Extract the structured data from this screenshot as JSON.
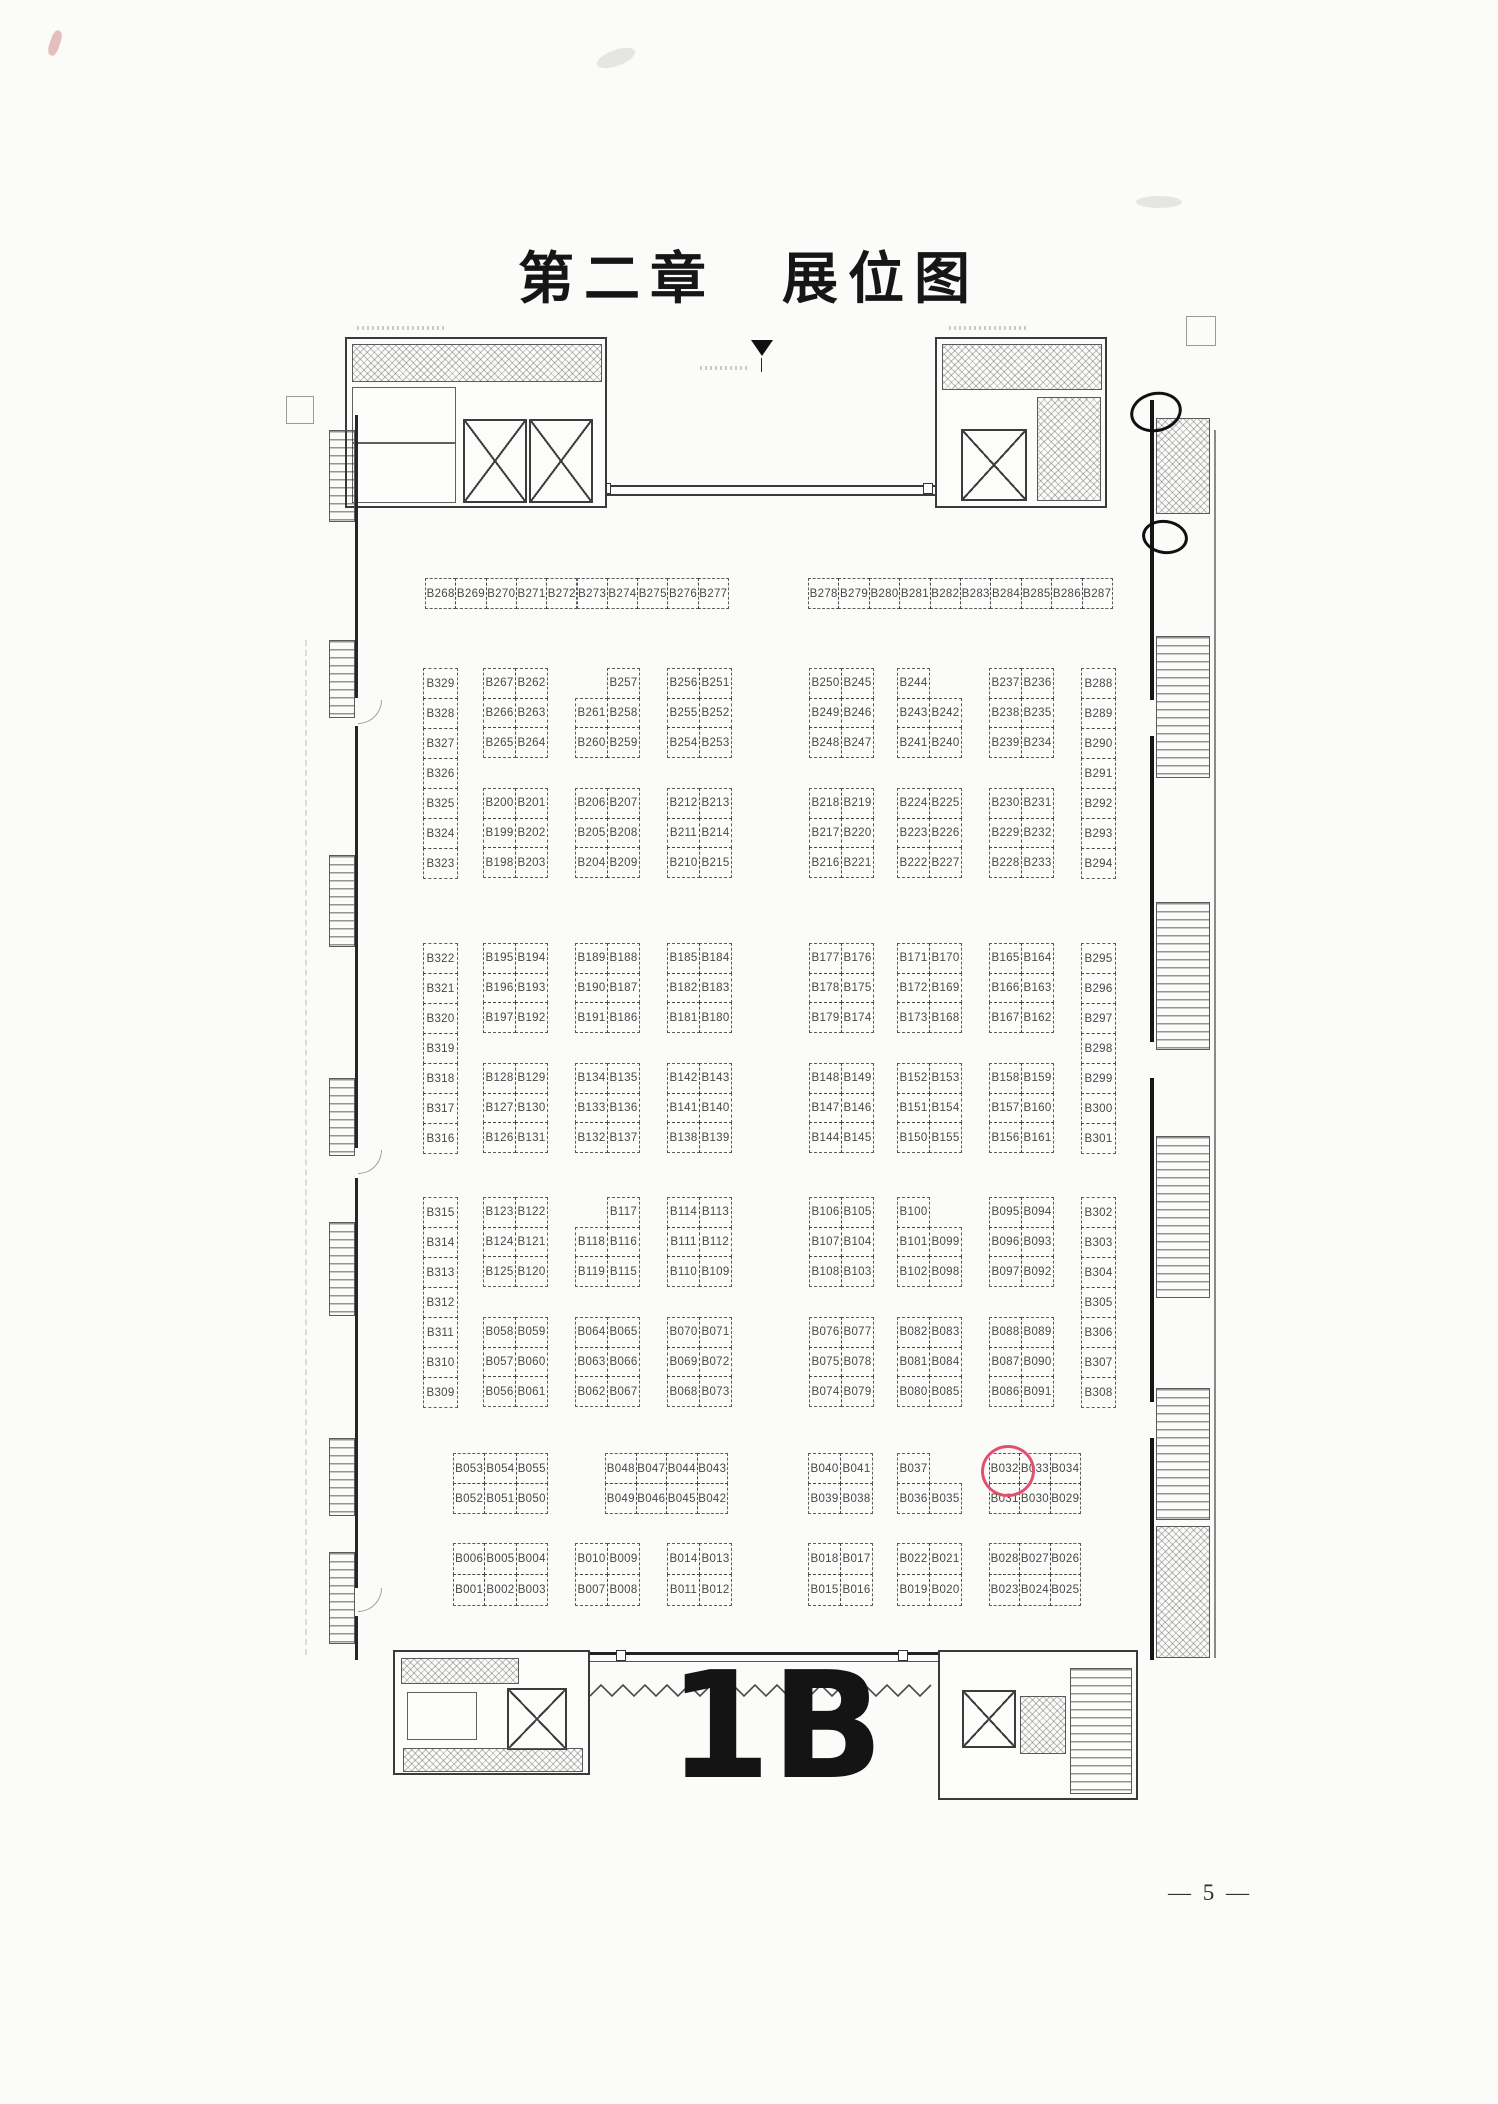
{
  "page": {
    "title": "第二章　展位图",
    "hall_label": "1B",
    "page_number": "— 5 —"
  },
  "plan": {
    "highlight": {
      "booth": "B032",
      "x": 981,
      "y": 1445,
      "w": 48,
      "h": 46,
      "color": "#e2506e"
    },
    "blocks": [
      {
        "id": "strip-top-left",
        "x": 425,
        "y": 578,
        "cw": 30.3,
        "rh": 30,
        "rows": [
          [
            "B268",
            "B269",
            "B270",
            "B271",
            "B272",
            "B273",
            "B274",
            "B275",
            "B276",
            "B277"
          ]
        ]
      },
      {
        "id": "strip-top-right",
        "x": 808,
        "y": 578,
        "cw": 30.4,
        "rh": 30,
        "rows": [
          [
            "B278",
            "B279",
            "B280",
            "B281",
            "B282",
            "B283",
            "B284",
            "B285",
            "B286",
            "B287"
          ]
        ]
      },
      {
        "id": "col-left-band1",
        "x": 423,
        "y": 668,
        "cw": 34,
        "rh": 30,
        "rows": [
          [
            "B329"
          ],
          [
            "B328"
          ],
          [
            "B327"
          ],
          [
            "B326"
          ],
          [
            "B325"
          ],
          [
            "B324"
          ],
          [
            "B323"
          ]
        ]
      },
      {
        "id": "col-right-band1",
        "x": 1081,
        "y": 668,
        "cw": 34,
        "rh": 30,
        "rows": [
          [
            "B288"
          ],
          [
            "B289"
          ],
          [
            "B290"
          ],
          [
            "B291"
          ],
          [
            "B292"
          ],
          [
            "B293"
          ],
          [
            "B294"
          ]
        ]
      },
      {
        "id": "col-left-band2",
        "x": 423,
        "y": 943,
        "cw": 34,
        "rh": 30,
        "rows": [
          [
            "B322"
          ],
          [
            "B321"
          ],
          [
            "B320"
          ],
          [
            "B319"
          ],
          [
            "B318"
          ],
          [
            "B317"
          ],
          [
            "B316"
          ]
        ]
      },
      {
        "id": "col-right-band2",
        "x": 1081,
        "y": 943,
        "cw": 34,
        "rh": 30,
        "rows": [
          [
            "B295"
          ],
          [
            "B296"
          ],
          [
            "B297"
          ],
          [
            "B298"
          ],
          [
            "B299"
          ],
          [
            "B300"
          ],
          [
            "B301"
          ]
        ]
      },
      {
        "id": "col-left-band3",
        "x": 423,
        "y": 1197,
        "cw": 34,
        "rh": 30,
        "rows": [
          [
            "B315"
          ],
          [
            "B314"
          ],
          [
            "B313"
          ],
          [
            "B312"
          ],
          [
            "B311"
          ],
          [
            "B310"
          ],
          [
            "B309"
          ]
        ]
      },
      {
        "id": "col-right-band3",
        "x": 1081,
        "y": 1197,
        "cw": 34,
        "rh": 30,
        "rows": [
          [
            "B302"
          ],
          [
            "B303"
          ],
          [
            "B304"
          ],
          [
            "B305"
          ],
          [
            "B306"
          ],
          [
            "B307"
          ],
          [
            "B308"
          ]
        ]
      },
      {
        "id": "grp-b-upper-1",
        "x": 483,
        "y": 668,
        "cw": 32,
        "rh": 29.7,
        "rows": [
          [
            "B267",
            "B262"
          ],
          [
            "B266",
            "B263"
          ],
          [
            "B265",
            "B264"
          ]
        ]
      },
      {
        "id": "grp-b-upper-2",
        "x": 575,
        "y": 668,
        "cw": 32,
        "rh": 29.7,
        "rows": [
          [
            null,
            "B257"
          ],
          [
            "B261",
            "B258"
          ],
          [
            "B260",
            "B259"
          ]
        ]
      },
      {
        "id": "grp-b-upper-3",
        "x": 667,
        "y": 668,
        "cw": 32,
        "rh": 29.7,
        "rows": [
          [
            "B256",
            "B251"
          ],
          [
            "B255",
            "B252"
          ],
          [
            "B254",
            "B253"
          ]
        ]
      },
      {
        "id": "grp-b-upper-4",
        "x": 809,
        "y": 668,
        "cw": 32,
        "rh": 29.7,
        "rows": [
          [
            "B250",
            "B245"
          ],
          [
            "B249",
            "B246"
          ],
          [
            "B248",
            "B247"
          ]
        ]
      },
      {
        "id": "grp-b-upper-5",
        "x": 897,
        "y": 668,
        "cw": 32,
        "rh": 29.7,
        "rows": [
          [
            "B244",
            null
          ],
          [
            "B243",
            "B242"
          ],
          [
            "B241",
            "B240"
          ]
        ]
      },
      {
        "id": "grp-b-upper-6",
        "x": 989,
        "y": 668,
        "cw": 32,
        "rh": 29.7,
        "rows": [
          [
            "B237",
            "B236"
          ],
          [
            "B238",
            "B235"
          ],
          [
            "B239",
            "B234"
          ]
        ]
      },
      {
        "id": "grp-b-lower-1",
        "x": 483,
        "y": 788,
        "cw": 32,
        "rh": 29.7,
        "rows": [
          [
            "B200",
            "B201"
          ],
          [
            "B199",
            "B202"
          ],
          [
            "B198",
            "B203"
          ]
        ]
      },
      {
        "id": "grp-b-lower-2",
        "x": 575,
        "y": 788,
        "cw": 32,
        "rh": 29.7,
        "rows": [
          [
            "B206",
            "B207"
          ],
          [
            "B205",
            "B208"
          ],
          [
            "B204",
            "B209"
          ]
        ]
      },
      {
        "id": "grp-b-lower-3",
        "x": 667,
        "y": 788,
        "cw": 32,
        "rh": 29.7,
        "rows": [
          [
            "B212",
            "B213"
          ],
          [
            "B211",
            "B214"
          ],
          [
            "B210",
            "B215"
          ]
        ]
      },
      {
        "id": "grp-b-lower-4",
        "x": 809,
        "y": 788,
        "cw": 32,
        "rh": 29.7,
        "rows": [
          [
            "B218",
            "B219"
          ],
          [
            "B217",
            "B220"
          ],
          [
            "B216",
            "B221"
          ]
        ]
      },
      {
        "id": "grp-b-lower-5",
        "x": 897,
        "y": 788,
        "cw": 32,
        "rh": 29.7,
        "rows": [
          [
            "B224",
            "B225"
          ],
          [
            "B223",
            "B226"
          ],
          [
            "B222",
            "B227"
          ]
        ]
      },
      {
        "id": "grp-b-lower-6",
        "x": 989,
        "y": 788,
        "cw": 32,
        "rh": 29.7,
        "rows": [
          [
            "B230",
            "B231"
          ],
          [
            "B229",
            "B232"
          ],
          [
            "B228",
            "B233"
          ]
        ]
      },
      {
        "id": "grp-c-upper-1",
        "x": 483,
        "y": 943,
        "cw": 32,
        "rh": 29.7,
        "rows": [
          [
            "B195",
            "B194"
          ],
          [
            "B196",
            "B193"
          ],
          [
            "B197",
            "B192"
          ]
        ]
      },
      {
        "id": "grp-c-upper-2",
        "x": 575,
        "y": 943,
        "cw": 32,
        "rh": 29.7,
        "rows": [
          [
            "B189",
            "B188"
          ],
          [
            "B190",
            "B187"
          ],
          [
            "B191",
            "B186"
          ]
        ]
      },
      {
        "id": "grp-c-upper-3",
        "x": 667,
        "y": 943,
        "cw": 32,
        "rh": 29.7,
        "rows": [
          [
            "B185",
            "B184"
          ],
          [
            "B182",
            "B183"
          ],
          [
            "B181",
            "B180"
          ]
        ]
      },
      {
        "id": "grp-c-upper-4",
        "x": 809,
        "y": 943,
        "cw": 32,
        "rh": 29.7,
        "rows": [
          [
            "B177",
            "B176"
          ],
          [
            "B178",
            "B175"
          ],
          [
            "B179",
            "B174"
          ]
        ]
      },
      {
        "id": "grp-c-upper-5",
        "x": 897,
        "y": 943,
        "cw": 32,
        "rh": 29.7,
        "rows": [
          [
            "B171",
            "B170"
          ],
          [
            "B172",
            "B169"
          ],
          [
            "B173",
            "B168"
          ]
        ]
      },
      {
        "id": "grp-c-upper-6",
        "x": 989,
        "y": 943,
        "cw": 32,
        "rh": 29.7,
        "rows": [
          [
            "B165",
            "B164"
          ],
          [
            "B166",
            "B163"
          ],
          [
            "B167",
            "B162"
          ]
        ]
      },
      {
        "id": "grp-c-lower-1",
        "x": 483,
        "y": 1063,
        "cw": 32,
        "rh": 29.7,
        "rows": [
          [
            "B128",
            "B129"
          ],
          [
            "B127",
            "B130"
          ],
          [
            "B126",
            "B131"
          ]
        ]
      },
      {
        "id": "grp-c-lower-2",
        "x": 575,
        "y": 1063,
        "cw": 32,
        "rh": 29.7,
        "rows": [
          [
            "B134",
            "B135"
          ],
          [
            "B133",
            "B136"
          ],
          [
            "B132",
            "B137"
          ]
        ]
      },
      {
        "id": "grp-c-lower-3",
        "x": 667,
        "y": 1063,
        "cw": 32,
        "rh": 29.7,
        "rows": [
          [
            "B142",
            "B143"
          ],
          [
            "B141",
            "B140"
          ],
          [
            "B138",
            "B139"
          ]
        ]
      },
      {
        "id": "grp-c-lower-4",
        "x": 809,
        "y": 1063,
        "cw": 32,
        "rh": 29.7,
        "rows": [
          [
            "B148",
            "B149"
          ],
          [
            "B147",
            "B146"
          ],
          [
            "B144",
            "B145"
          ]
        ]
      },
      {
        "id": "grp-c-lower-5",
        "x": 897,
        "y": 1063,
        "cw": 32,
        "rh": 29.7,
        "rows": [
          [
            "B152",
            "B153"
          ],
          [
            "B151",
            "B154"
          ],
          [
            "B150",
            "B155"
          ]
        ]
      },
      {
        "id": "grp-c-lower-6",
        "x": 989,
        "y": 1063,
        "cw": 32,
        "rh": 29.7,
        "rows": [
          [
            "B158",
            "B159"
          ],
          [
            "B157",
            "B160"
          ],
          [
            "B156",
            "B161"
          ]
        ]
      },
      {
        "id": "grp-d-upper-1",
        "x": 483,
        "y": 1197,
        "cw": 32,
        "rh": 29.7,
        "rows": [
          [
            "B123",
            "B122"
          ],
          [
            "B124",
            "B121"
          ],
          [
            "B125",
            "B120"
          ]
        ]
      },
      {
        "id": "grp-d-upper-2",
        "x": 575,
        "y": 1197,
        "cw": 32,
        "rh": 29.7,
        "rows": [
          [
            null,
            "B117"
          ],
          [
            "B118",
            "B116"
          ],
          [
            "B119",
            "B115"
          ]
        ]
      },
      {
        "id": "grp-d-upper-3",
        "x": 667,
        "y": 1197,
        "cw": 32,
        "rh": 29.7,
        "rows": [
          [
            "B114",
            "B113"
          ],
          [
            "B111",
            "B112"
          ],
          [
            "B110",
            "B109"
          ]
        ]
      },
      {
        "id": "grp-d-upper-4",
        "x": 809,
        "y": 1197,
        "cw": 32,
        "rh": 29.7,
        "rows": [
          [
            "B106",
            "B105"
          ],
          [
            "B107",
            "B104"
          ],
          [
            "B108",
            "B103"
          ]
        ]
      },
      {
        "id": "grp-d-upper-5",
        "x": 897,
        "y": 1197,
        "cw": 32,
        "rh": 29.7,
        "rows": [
          [
            "B100",
            null
          ],
          [
            "B101",
            "B099"
          ],
          [
            "B102",
            "B098"
          ]
        ]
      },
      {
        "id": "grp-d-upper-6",
        "x": 989,
        "y": 1197,
        "cw": 32,
        "rh": 29.7,
        "rows": [
          [
            "B095",
            "B094"
          ],
          [
            "B096",
            "B093"
          ],
          [
            "B097",
            "B092"
          ]
        ]
      },
      {
        "id": "grp-d-lower-1",
        "x": 483,
        "y": 1317,
        "cw": 32,
        "rh": 29.7,
        "rows": [
          [
            "B058",
            "B059"
          ],
          [
            "B057",
            "B060"
          ],
          [
            "B056",
            "B061"
          ]
        ]
      },
      {
        "id": "grp-d-lower-2",
        "x": 575,
        "y": 1317,
        "cw": 32,
        "rh": 29.7,
        "rows": [
          [
            "B064",
            "B065"
          ],
          [
            "B063",
            "B066"
          ],
          [
            "B062",
            "B067"
          ]
        ]
      },
      {
        "id": "grp-d-lower-3",
        "x": 667,
        "y": 1317,
        "cw": 32,
        "rh": 29.7,
        "rows": [
          [
            "B070",
            "B071"
          ],
          [
            "B069",
            "B072"
          ],
          [
            "B068",
            "B073"
          ]
        ]
      },
      {
        "id": "grp-d-lower-4",
        "x": 809,
        "y": 1317,
        "cw": 32,
        "rh": 29.7,
        "rows": [
          [
            "B076",
            "B077"
          ],
          [
            "B075",
            "B078"
          ],
          [
            "B074",
            "B079"
          ]
        ]
      },
      {
        "id": "grp-d-lower-5",
        "x": 897,
        "y": 1317,
        "cw": 32,
        "rh": 29.7,
        "rows": [
          [
            "B082",
            "B083"
          ],
          [
            "B081",
            "B084"
          ],
          [
            "B080",
            "B085"
          ]
        ]
      },
      {
        "id": "grp-d-lower-6",
        "x": 989,
        "y": 1317,
        "cw": 32,
        "rh": 29.7,
        "rows": [
          [
            "B088",
            "B089"
          ],
          [
            "B087",
            "B090"
          ],
          [
            "B086",
            "B091"
          ]
        ]
      },
      {
        "id": "grp-e-1",
        "x": 453,
        "y": 1453,
        "cw": 31.3,
        "rh": 30,
        "rows": [
          [
            "B053",
            "B054",
            "B055"
          ],
          [
            "B052",
            "B051",
            "B050"
          ]
        ]
      },
      {
        "id": "grp-e-2",
        "x": 605,
        "y": 1453,
        "cw": 30.5,
        "rh": 30,
        "rows": [
          [
            "B048",
            "B047",
            "B044",
            "B043"
          ],
          [
            "B049",
            "B046",
            "B045",
            "B042"
          ]
        ]
      },
      {
        "id": "grp-e-3",
        "x": 808,
        "y": 1453,
        "cw": 32,
        "rh": 30,
        "rows": [
          [
            "B040",
            "B041"
          ],
          [
            "B039",
            "B038"
          ]
        ]
      },
      {
        "id": "grp-e-4",
        "x": 897,
        "y": 1453,
        "cw": 32,
        "rh": 30,
        "rows": [
          [
            "B037",
            null
          ],
          [
            "B036",
            "B035"
          ]
        ]
      },
      {
        "id": "grp-e-5",
        "x": 989,
        "y": 1453,
        "cw": 30.3,
        "rh": 30,
        "rows": [
          [
            "B032",
            "B033",
            "B034"
          ],
          [
            "B031",
            "B030",
            "B029"
          ]
        ]
      },
      {
        "id": "grp-f-1",
        "x": 453,
        "y": 1543,
        "cw": 31.3,
        "rh": 31,
        "rows": [
          [
            "B006",
            "B005",
            "B004"
          ],
          [
            "B001",
            "B002",
            "B003"
          ]
        ]
      },
      {
        "id": "grp-f-2",
        "x": 575,
        "y": 1543,
        "cw": 32,
        "rh": 31,
        "rows": [
          [
            "B010",
            "B009"
          ],
          [
            "B007",
            "B008"
          ]
        ]
      },
      {
        "id": "grp-f-3",
        "x": 667,
        "y": 1543,
        "cw": 32,
        "rh": 31,
        "rows": [
          [
            "B014",
            "B013"
          ],
          [
            "B011",
            "B012"
          ]
        ]
      },
      {
        "id": "grp-f-4",
        "x": 808,
        "y": 1543,
        "cw": 32,
        "rh": 31,
        "rows": [
          [
            "B018",
            "B017"
          ],
          [
            "B015",
            "B016"
          ]
        ]
      },
      {
        "id": "grp-f-5",
        "x": 897,
        "y": 1543,
        "cw": 32,
        "rh": 31,
        "rows": [
          [
            "B022",
            "B021"
          ],
          [
            "B019",
            "B020"
          ]
        ]
      },
      {
        "id": "grp-f-6",
        "x": 989,
        "y": 1543,
        "cw": 30.3,
        "rh": 31,
        "rows": [
          [
            "B028",
            "B027",
            "B026"
          ],
          [
            "B023",
            "B024",
            "B025"
          ]
        ]
      }
    ]
  }
}
